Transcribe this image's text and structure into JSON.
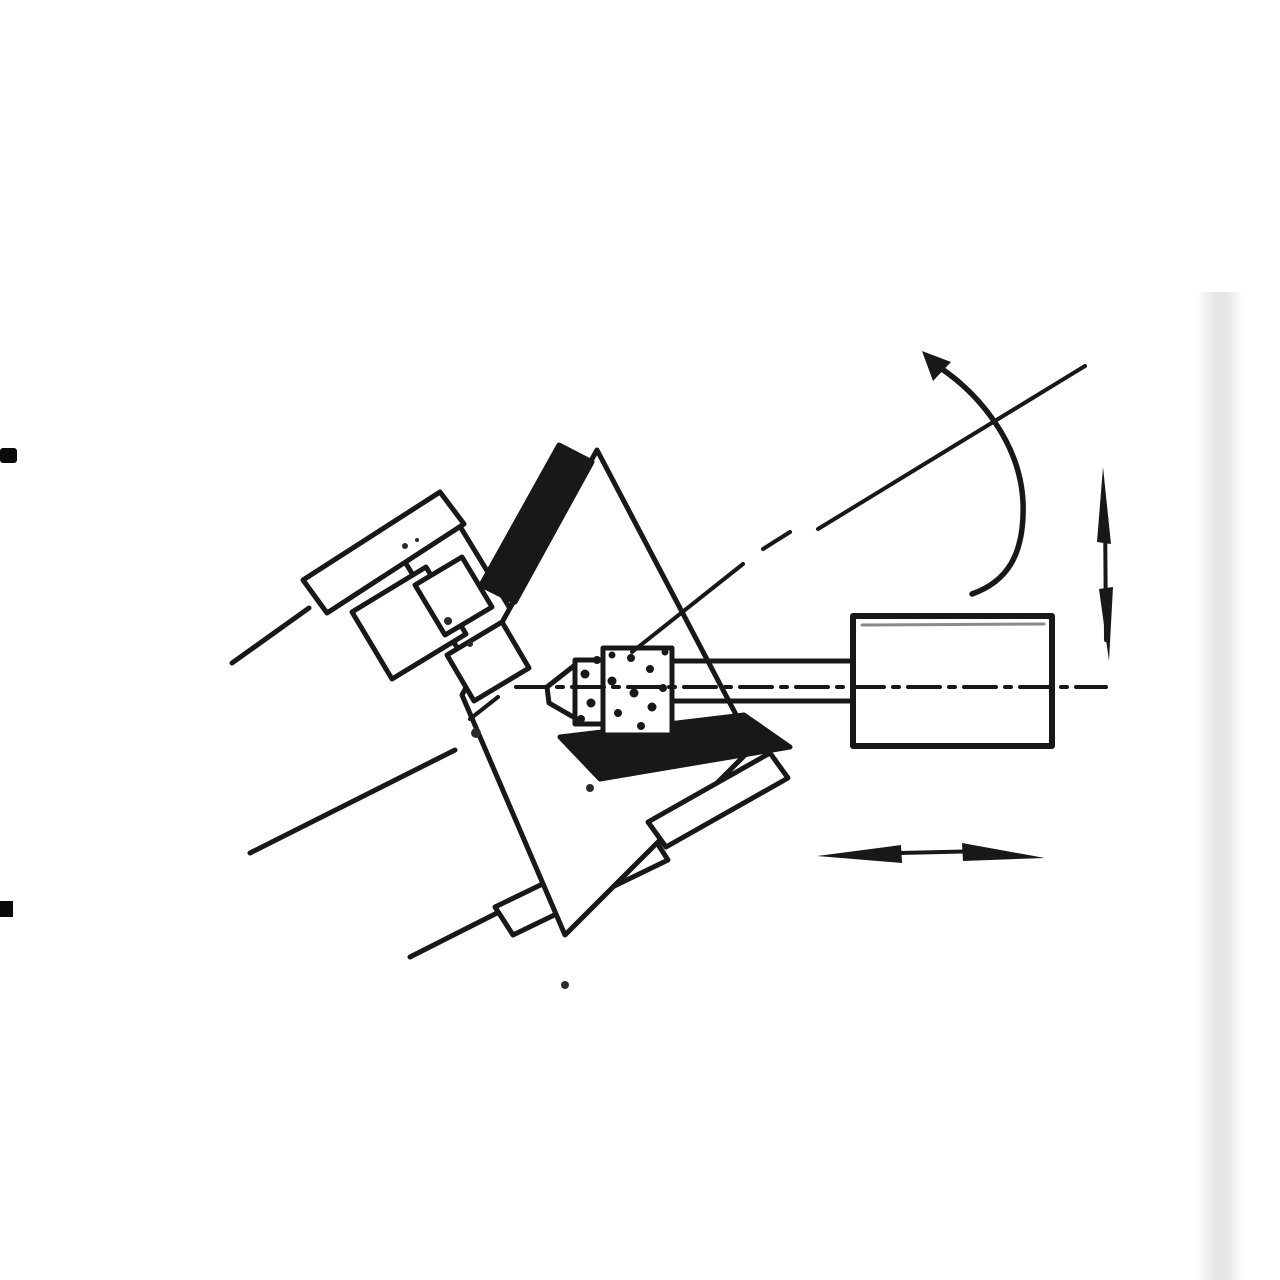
{
  "canvas": {
    "width": 1280,
    "height": 1280,
    "background": "#ffffff",
    "ink": "#181818",
    "shade_gray": "#e2e2e2",
    "inner_gray": "#8a8a8a"
  },
  "parts": {
    "workpiece": "workpiece ring (sectioned)",
    "section_wedge": "solid black section wedge of workpiece wall",
    "bore_shadow": "solid black lower bore section band",
    "chuck_faceplate": "chuck faceplate / backing plate",
    "upper_clamp_bar": "upper clamp bar",
    "upper_clamp_stem": "upper clamp stem",
    "clamp_block_a": "clamp step block (upper left of workpiece)",
    "clamp_block_b": "clamp step block (lower left of workpiece)",
    "lower_clamp_bar": "lower clamp bar",
    "lower_clamp_finger": "lower clamp finger",
    "spindle_lines": "machine spindle edge lines",
    "grinding_wheel": "internal grinding wheel with abrasive stipple",
    "wheel_quill": "grinding wheel quill / spindle shaft",
    "wheelhead": "wheelhead housing",
    "spindle_centerline": "horizontal wheel-spindle centerline (dash-dot)",
    "workpiece_axis": "inclined workpiece axis centerline (dash-dot)",
    "rotation_arrow": "curved workpiece rotation arrow",
    "infeed_arrow": "vertical double-headed infeed arrow",
    "traverse_arrow": "horizontal double-headed traverse arrow",
    "page_edge_band": "faint scanned page edge band",
    "margin_mark_top": "cropped black margin mark (upper left edge)",
    "margin_mark_bottom": "cropped black margin mark (lower left edge)",
    "scan_specks": "small scan specks on clamp faces"
  },
  "icons": {
    "rotation_arrow_glyph": "curved-arrow",
    "infeed_arrow_glyph": "up-down-arrow",
    "traverse_arrow_glyph": "left-right-arrow"
  }
}
